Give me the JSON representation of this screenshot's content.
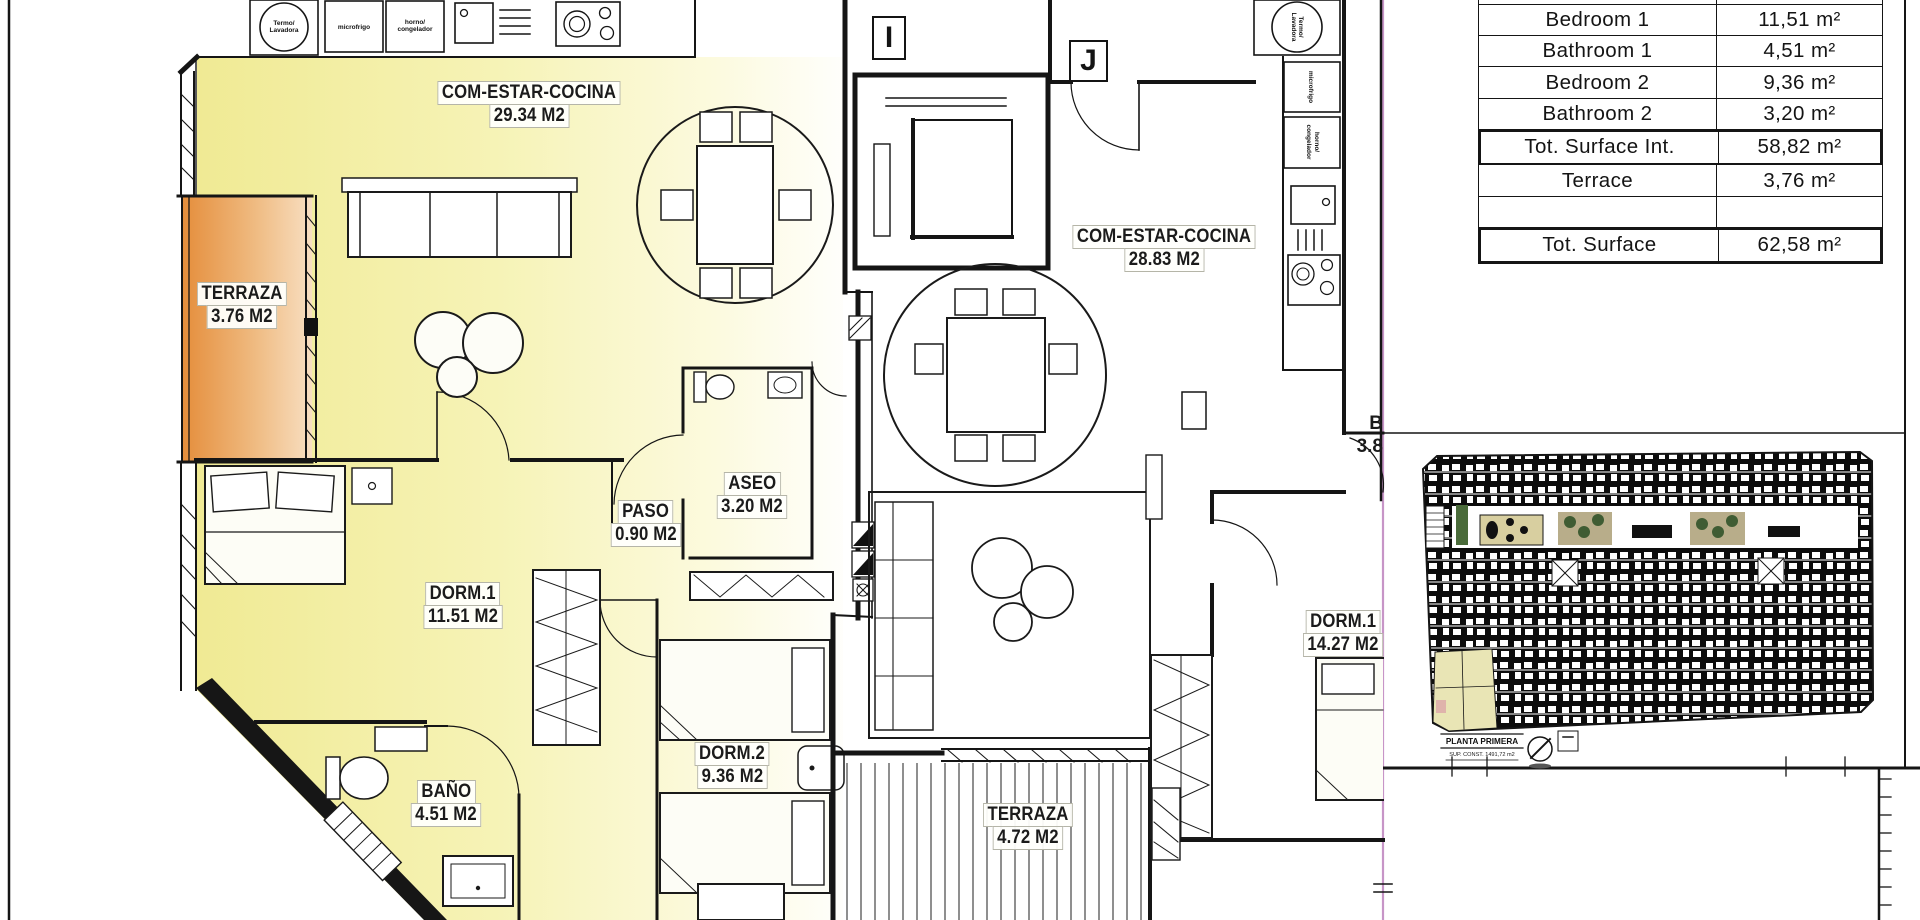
{
  "units": {
    "unit_i": {
      "letter": "I",
      "rooms": [
        {
          "name": "COM-ESTAR-COCINA",
          "area": "29.34 M2"
        },
        {
          "name": "TERRAZA",
          "area": "3.76 M2"
        },
        {
          "name": "DORM.1",
          "area": "11.51 M2"
        },
        {
          "name": "PASO",
          "area": "0.90 M2"
        },
        {
          "name": "ASEO",
          "area": "3.20 M2"
        },
        {
          "name": "BAÑO",
          "area": "4.51 M2"
        },
        {
          "name": "DORM.2",
          "area": "9.36 M2"
        }
      ]
    },
    "unit_j": {
      "letter": "J",
      "rooms": [
        {
          "name": "COM-ESTAR-COCINA",
          "area": "28.83 M2"
        },
        {
          "name": "DORM.1",
          "area": "14.27 M2"
        },
        {
          "name": "TERRAZA",
          "area": "4.72 M2"
        }
      ],
      "partial_room": {
        "name": "B",
        "area": "3.8"
      }
    }
  },
  "appliances": {
    "termo_line1": "Termo/",
    "termo_line2": "Lavadora",
    "micro": "microfrigo",
    "horno_line1": "horno/",
    "horno_line2": "congelador"
  },
  "surface_table": {
    "rows": [
      {
        "label": "Bedroom 1",
        "value": "11,51 m²"
      },
      {
        "label": "Bathroom 1",
        "value": "4,51 m²"
      },
      {
        "label": "Bedroom 2",
        "value": "9,36 m²"
      },
      {
        "label": "Bathroom 2",
        "value": "3,20 m²"
      },
      {
        "label": "Tot. Surface Int.",
        "value": "58,82 m²"
      },
      {
        "label": "Terrace",
        "value": "3,76 m²"
      },
      {
        "label": "",
        "value": ""
      },
      {
        "label": "Tot. Surface",
        "value": "62,58 m²"
      }
    ]
  },
  "overview": {
    "title": "PLANTA PRIMERA",
    "subtitle": "SUP. CONST. 1491,72 m2"
  },
  "colors": {
    "unit_fill": "#f2eda0",
    "terrace_fill": "#e58e3c",
    "panel_divider": "#c795c7"
  }
}
